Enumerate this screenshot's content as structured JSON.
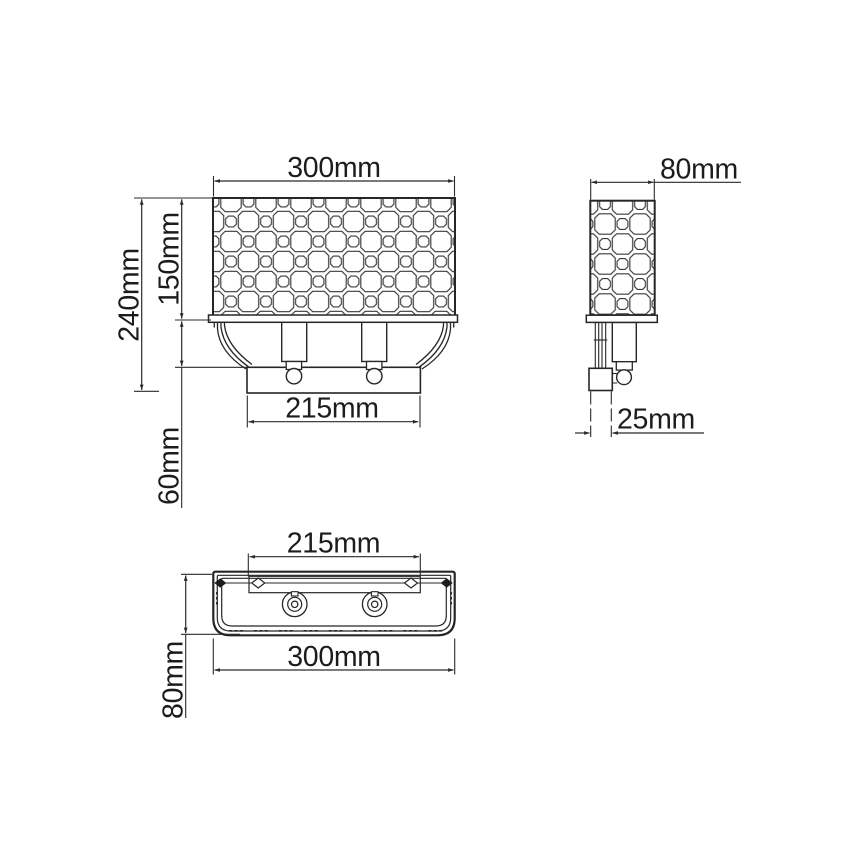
{
  "labels": {
    "front": {
      "width": "300mm",
      "total_height": "240mm",
      "shade_height": "150mm",
      "plate_width": "215mm",
      "shade_to_plate": "60mm"
    },
    "side": {
      "depth": "80mm",
      "wall_plate": "25mm"
    },
    "top": {
      "plate_width": "215mm",
      "width": "300mm",
      "depth": "80mm"
    }
  },
  "colors": {
    "line": "#2a2a2a",
    "text": "#1c1c1c",
    "background": "#ffffff"
  }
}
